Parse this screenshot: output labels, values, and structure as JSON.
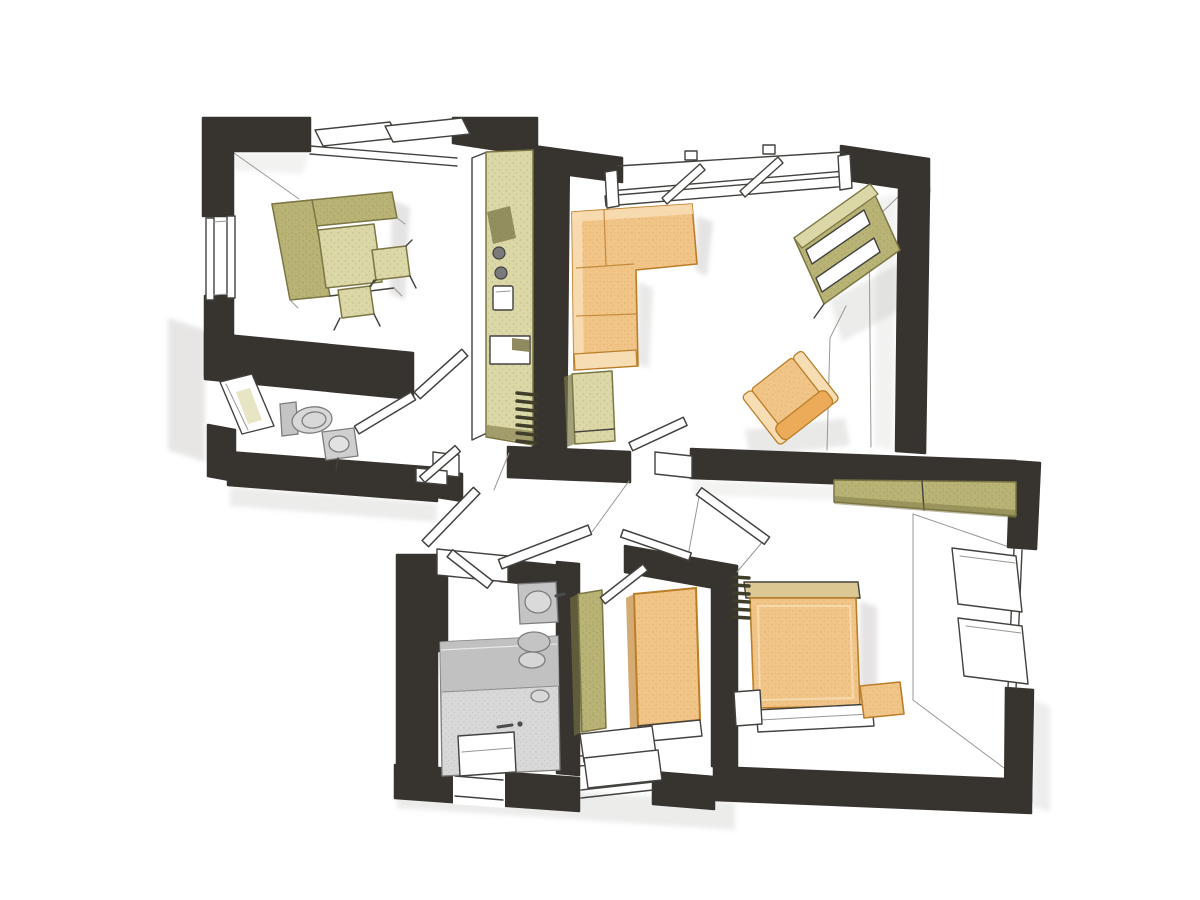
{
  "title": "Hand-drawn apartment floor plan sketch, bird's-eye view with furnished rooms",
  "colors": {
    "paper": "#ffffff",
    "wall": "#37332e",
    "line": "#44423e",
    "lineSoft": "#9a9894",
    "orange": "#f1c488",
    "orangeDark": "#bb7e28",
    "orangeLight": "#f7ddb4",
    "tan": "#dcc892",
    "olive": "#b9b475",
    "oliveDark": "#7b7644",
    "oliveLight": "#dbd7a6",
    "grayFix": "#c4c4c4",
    "grayFixDark": "#7d7d7d",
    "grayFloor": "#d8d8d8",
    "grayFloorDark": "#bdbdbd",
    "shadow": "#a9a7a3",
    "radiator": "#3f3e2a"
  },
  "rooms": [
    {
      "name": "study-with-kitchenette",
      "furniture": [
        "corner-sofa-green",
        "seat-cushion",
        "side-table",
        "side-table",
        "kitchen-counter",
        "cooktop",
        "kitchen-sink"
      ],
      "windows": 2,
      "position": "top-left"
    },
    {
      "name": "living-room",
      "furniture": [
        "corner-sofa-orange",
        "armchair",
        "wall-shelf",
        "tall-cabinet",
        "floor-lamp-wire"
      ],
      "windows": 1,
      "position": "top-right"
    },
    {
      "name": "wc",
      "furniture": [
        "toilet",
        "hand-basin"
      ],
      "windows": 1,
      "position": "middle-left"
    },
    {
      "name": "hallway",
      "furniture": [
        "radiator"
      ],
      "windows": 0,
      "position": "center"
    },
    {
      "name": "bathroom",
      "furniture": [
        "shower-tub",
        "washbasin",
        "toilet",
        "step-box"
      ],
      "windows": 1,
      "position": "bottom-left"
    },
    {
      "name": "dressing-hall",
      "furniture": [
        "wardrobe-green",
        "wardrobe-orange",
        "bench",
        "bench"
      ],
      "windows": 1,
      "position": "bottom-center"
    },
    {
      "name": "bedroom",
      "furniture": [
        "double-bed",
        "headboard",
        "nightstand",
        "nightstand",
        "foot-bench",
        "wardrobe-green",
        "radiator"
      ],
      "windows": 1,
      "position": "bottom-right"
    }
  ],
  "doors_open": 10,
  "style": "black marker walls with colored pencil furniture on white paper"
}
